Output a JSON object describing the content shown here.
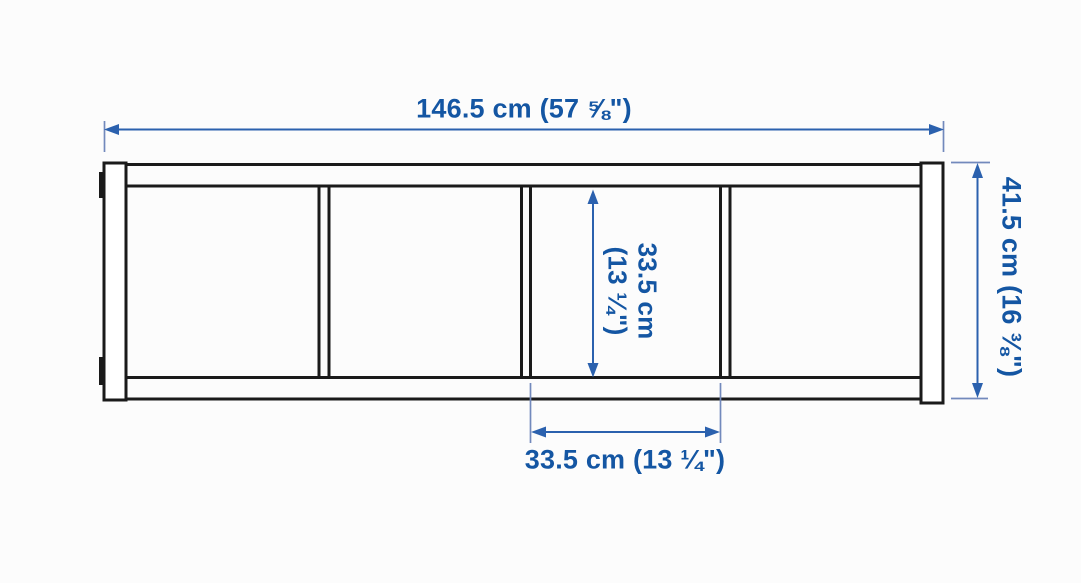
{
  "colors": {
    "bg": "#fcfcfc",
    "outline": "#1a1a1a",
    "dim-blue": "#1456a3",
    "dim-line": "#2b61ae",
    "dim-ext": "#7289bc"
  },
  "diagram": {
    "unit": {
      "compartments": 4
    },
    "dimensions": {
      "overall_width": {
        "label": "146.5 cm (57 ⅝\")",
        "cm": 146.5
      },
      "overall_height": {
        "label": "41.5 cm (16 ⅜\")",
        "cm": 41.5
      },
      "compartment_height": {
        "line1": "33.5 cm",
        "line2": "(13 ¼\")",
        "cm": 33.5
      },
      "compartment_width": {
        "label": "33.5 cm (13 ¼\")",
        "cm": 33.5
      }
    }
  }
}
